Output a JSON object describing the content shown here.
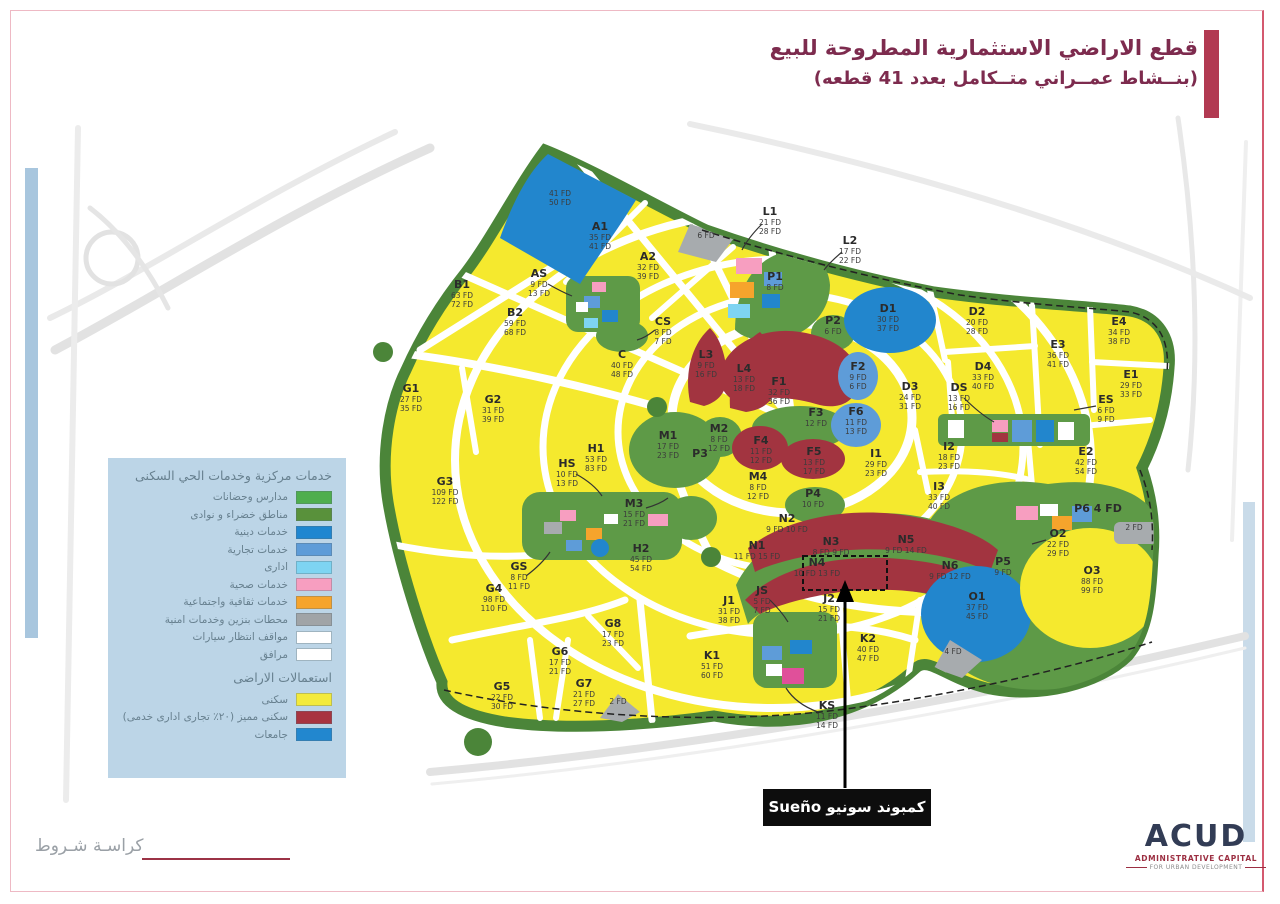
{
  "title": {
    "line1": "قطع الاراضي الاستثمارية المطروحة للبيع",
    "line2": "(بنــشاط عمــراني متــكامل بعدد 41 قطعه)"
  },
  "legend": {
    "header": "خدمات مركزية وخدمات الحي السكنى",
    "items": [
      {
        "label": "مدارس وحضانات",
        "color": "#4fae4e"
      },
      {
        "label": "مناطق خضراء و نوادى",
        "color": "#59913b"
      },
      {
        "label": "خدمات دينية",
        "color": "#1f86d0"
      },
      {
        "label": "خدمات تجارية",
        "color": "#5e9cd8"
      },
      {
        "label": "ادارى",
        "color": "#7ed4f2"
      },
      {
        "label": "خدمات صحية",
        "color": "#f79ec0"
      },
      {
        "label": "خدمات ثقافية واجتماعية",
        "color": "#f6a42c"
      },
      {
        "label": "محطات بنزين وخدمات امنية",
        "color": "#a0a4a7"
      },
      {
        "label": "مواقف انتظار سيارات",
        "color": "#ffffff"
      },
      {
        "label": "مرافق",
        "color": "#ffffff"
      }
    ],
    "section2": "استعمالات الاراضى",
    "items2": [
      {
        "label": "سكنى",
        "color": "#f3ea3c"
      },
      {
        "label": "سكنى مميز (٢٠٪ تجارى ادارى خدمى)",
        "color": "#a83440"
      },
      {
        "label": "جامعات",
        "color": "#2287cf"
      }
    ]
  },
  "annotation": {
    "compound_label": "كمبوند سونيو Sueño"
  },
  "footer": {
    "left_text": "كراسـة شـروط"
  },
  "logo": {
    "name": "ACUD",
    "line1": "ADMINISTRATIVE CAPITAL",
    "line2": "FOR URBAN DEVELOPMENT"
  },
  "colors": {
    "residential": "#f5e92e",
    "premium_residential": "#a23440",
    "university": "#2286cd",
    "green": "#5e9a47",
    "belt": "#4b8539",
    "gray": "#a7abae",
    "accent": "#b23a52"
  },
  "plots": [
    {
      "id": "U1",
      "label": "",
      "values": [
        "41 FD",
        "50 FD"
      ],
      "type": "university"
    },
    {
      "id": "A1",
      "label": "A1",
      "values": [
        "35 FD",
        "41 FD"
      ],
      "type": "residential"
    },
    {
      "id": "A2",
      "label": "A2",
      "values": [
        "32 FD",
        "39 FD"
      ],
      "type": "residential"
    },
    {
      "id": "AS",
      "label": "AS",
      "values": [
        "9 FD",
        "13 FD"
      ],
      "type": "services"
    },
    {
      "id": "B1",
      "label": "B1",
      "values": [
        "63 FD",
        "72 FD"
      ],
      "type": "residential"
    },
    {
      "id": "B2",
      "label": "B2",
      "values": [
        "59 FD",
        "68 FD"
      ],
      "type": "residential"
    },
    {
      "id": "C",
      "label": "C",
      "values": [
        "40 FD",
        "48 FD"
      ],
      "type": "residential"
    },
    {
      "id": "CS",
      "label": "CS",
      "values": [
        "8 FD",
        "7 FD"
      ],
      "type": "services"
    },
    {
      "id": "D1",
      "label": "D1",
      "values": [
        "30 FD",
        "37 FD"
      ],
      "type": "university"
    },
    {
      "id": "D2",
      "label": "D2",
      "values": [
        "20 FD",
        "28 FD"
      ],
      "type": "residential"
    },
    {
      "id": "D3",
      "label": "D3",
      "values": [
        "24 FD",
        "31 FD"
      ],
      "type": "residential"
    },
    {
      "id": "D4",
      "label": "D4",
      "values": [
        "33 FD",
        "40 FD"
      ],
      "type": "residential"
    },
    {
      "id": "DS",
      "label": "DS",
      "values": [
        "13 FD",
        "16 FD"
      ],
      "type": "services"
    },
    {
      "id": "E1",
      "label": "E1",
      "values": [
        "29 FD",
        "33 FD"
      ],
      "type": "residential"
    },
    {
      "id": "E2",
      "label": "E2",
      "values": [
        "42 FD",
        "54 FD"
      ],
      "type": "residential"
    },
    {
      "id": "E3",
      "label": "E3",
      "values": [
        "36 FD",
        "41 FD"
      ],
      "type": "residential"
    },
    {
      "id": "E4",
      "label": "E4",
      "values": [
        "34 FD",
        "38 FD"
      ],
      "type": "residential"
    },
    {
      "id": "ES",
      "label": "ES",
      "values": [
        "6 FD",
        "9 FD"
      ],
      "type": "services"
    },
    {
      "id": "F1",
      "label": "F1",
      "values": [
        "32 FD",
        "36 FD"
      ],
      "type": "premium_residential"
    },
    {
      "id": "F2",
      "label": "F2",
      "values": [
        "9 FD",
        "6 FD"
      ],
      "type": "university"
    },
    {
      "id": "F3",
      "label": "F3",
      "values": [
        "12 FD"
      ],
      "type": "green"
    },
    {
      "id": "F4",
      "label": "F4",
      "values": [
        "11 FD",
        "12 FD"
      ],
      "type": "premium_residential"
    },
    {
      "id": "F5",
      "label": "F5",
      "values": [
        "13 FD",
        "17 FD"
      ],
      "type": "premium_residential"
    },
    {
      "id": "F6",
      "label": "F6",
      "values": [
        "11 FD",
        "13 FD"
      ],
      "type": "university"
    },
    {
      "id": "G1",
      "label": "G1",
      "values": [
        "27 FD",
        "35 FD"
      ],
      "type": "residential"
    },
    {
      "id": "G2",
      "label": "G2",
      "values": [
        "31 FD",
        "39 FD"
      ],
      "type": "residential"
    },
    {
      "id": "G3",
      "label": "G3",
      "values": [
        "109 FD",
        "122 FD"
      ],
      "type": "residential"
    },
    {
      "id": "G4",
      "label": "G4",
      "values": [
        "98 FD",
        "110 FD"
      ],
      "type": "residential"
    },
    {
      "id": "G5",
      "label": "G5",
      "values": [
        "22 FD",
        "30 FD"
      ],
      "type": "residential"
    },
    {
      "id": "G6",
      "label": "G6",
      "values": [
        "17 FD",
        "21 FD"
      ],
      "type": "residential"
    },
    {
      "id": "G7",
      "label": "G7",
      "values": [
        "21 FD",
        "27 FD"
      ],
      "type": "residential"
    },
    {
      "id": "G8",
      "label": "G8",
      "values": [
        "17 FD",
        "23 FD"
      ],
      "type": "residential"
    },
    {
      "id": "GS",
      "label": "GS",
      "values": [
        "8 FD",
        "11 FD"
      ],
      "type": "services"
    },
    {
      "id": "H1",
      "label": "H1",
      "values": [
        "53 FD",
        "83 FD"
      ],
      "type": "residential"
    },
    {
      "id": "H2",
      "label": "H2",
      "values": [
        "45 FD",
        "54 FD"
      ],
      "type": "residential"
    },
    {
      "id": "HS",
      "label": "HS",
      "values": [
        "10 FD",
        "13 FD"
      ],
      "type": "services"
    },
    {
      "id": "I1",
      "label": "I1",
      "values": [
        "29 FD",
        "23 FD"
      ],
      "type": "residential"
    },
    {
      "id": "I2",
      "label": "I2",
      "values": [
        "18 FD",
        "23 FD"
      ],
      "type": "residential"
    },
    {
      "id": "I3",
      "label": "I3",
      "values": [
        "33 FD",
        "40 FD"
      ],
      "type": "residential"
    },
    {
      "id": "J1",
      "label": "J1",
      "values": [
        "31 FD",
        "38 FD"
      ],
      "type": "residential"
    },
    {
      "id": "J2",
      "label": "J2",
      "values": [
        "15 FD",
        "21 FD"
      ],
      "type": "residential"
    },
    {
      "id": "JS",
      "label": "JS",
      "values": [
        "5 FD",
        "7 FD"
      ],
      "type": "services"
    },
    {
      "id": "K1",
      "label": "K1",
      "values": [
        "51 FD",
        "60 FD"
      ],
      "type": "residential"
    },
    {
      "id": "K2",
      "label": "K2",
      "values": [
        "40 FD",
        "47 FD"
      ],
      "type": "residential"
    },
    {
      "id": "KS",
      "label": "KS",
      "values": [
        "11 FD",
        "14 FD"
      ],
      "type": "services"
    },
    {
      "id": "L1",
      "label": "L1",
      "values": [
        "21 FD",
        "28 FD"
      ],
      "type": "services"
    },
    {
      "id": "L2",
      "label": "L2",
      "values": [
        "17 FD",
        "22 FD"
      ],
      "type": "services"
    },
    {
      "id": "L3",
      "label": "L3",
      "values": [
        "9 FD",
        "16 FD"
      ],
      "type": "premium_residential"
    },
    {
      "id": "L4",
      "label": "L4",
      "values": [
        "13 FD",
        "18 FD"
      ],
      "type": "premium_residential"
    },
    {
      "id": "M1",
      "label": "M1",
      "values": [
        "17 FD",
        "23 FD"
      ],
      "type": "green"
    },
    {
      "id": "M2",
      "label": "M2",
      "values": [
        "8 FD",
        "12 FD"
      ],
      "type": "green"
    },
    {
      "id": "M3",
      "label": "M3",
      "values": [
        "15 FD",
        "21 FD"
      ],
      "type": "green"
    },
    {
      "id": "M4",
      "label": "M4",
      "values": [
        "8 FD",
        "12 FD"
      ],
      "type": "services"
    },
    {
      "id": "N1",
      "label": "N1",
      "values": [
        "11 FD",
        "15 FD"
      ],
      "type": "premium_residential"
    },
    {
      "id": "N2",
      "label": "N2",
      "values": [
        "9 FD",
        "10 FD"
      ],
      "type": "premium_residential"
    },
    {
      "id": "N3",
      "label": "N3",
      "values": [
        "8 FD",
        "9 FD"
      ],
      "type": "premium_residential"
    },
    {
      "id": "N4",
      "label": "N4",
      "values": [
        "10 FD",
        "13 FD"
      ],
      "type": "premium_residential"
    },
    {
      "id": "N5",
      "label": "N5",
      "values": [
        "9 FD",
        "14 FD"
      ],
      "type": "premium_residential"
    },
    {
      "id": "N6",
      "label": "N6",
      "values": [
        "9 FD",
        "12 FD"
      ],
      "type": "premium_residential"
    },
    {
      "id": "O1",
      "label": "O1",
      "values": [
        "37 FD",
        "45 FD"
      ],
      "type": "university"
    },
    {
      "id": "O2",
      "label": "O2",
      "values": [
        "22 FD",
        "29 FD"
      ],
      "type": "residential"
    },
    {
      "id": "O3",
      "label": "O3",
      "values": [
        "88 FD",
        "99 FD"
      ],
      "type": "residential"
    },
    {
      "id": "P1",
      "label": "P1",
      "values": [
        "8 FD"
      ],
      "type": "green"
    },
    {
      "id": "P2",
      "label": "P2",
      "values": [
        "6 FD"
      ],
      "type": "green"
    },
    {
      "id": "P3",
      "label": "P3",
      "values": [],
      "type": "green"
    },
    {
      "id": "P4",
      "label": "P4",
      "values": [
        "10 FD"
      ],
      "type": "green"
    },
    {
      "id": "P5",
      "label": "P5",
      "values": [
        "9 FD"
      ],
      "type": "green"
    },
    {
      "id": "P6",
      "label": "P6",
      "values": [
        "4 FD"
      ],
      "type": "green"
    },
    {
      "id": "X1",
      "label": "",
      "values": [
        "6 FD"
      ],
      "type": "utility_gray"
    },
    {
      "id": "X2",
      "label": "",
      "values": [
        "2 FD"
      ],
      "type": "utility_gray"
    },
    {
      "id": "X3",
      "label": "",
      "values": [
        "4 FD"
      ],
      "type": "utility_gray"
    },
    {
      "id": "X4",
      "label": "",
      "values": [
        "2 FD"
      ],
      "type": "utility_gray"
    }
  ]
}
